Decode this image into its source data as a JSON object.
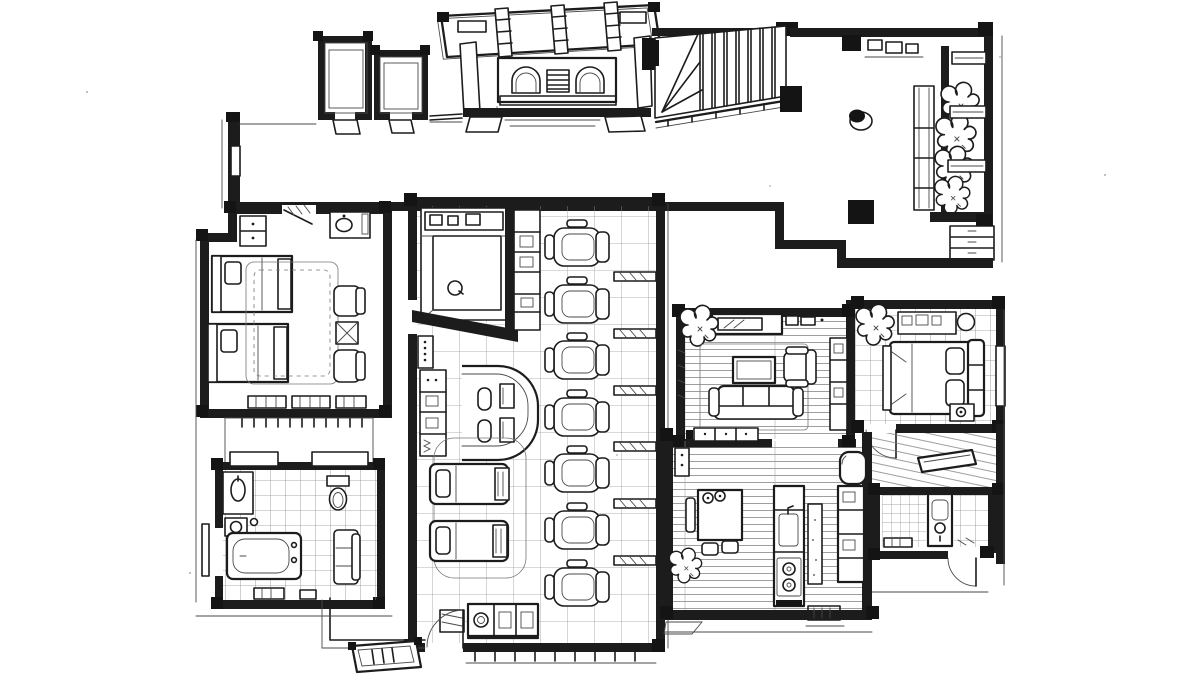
{
  "meta": {
    "title": "Hand-drawn ink floor plan",
    "medium": "black ink line drawing on white paper, axonometric apartment-salon layout",
    "palette": {
      "ink": "#1c1c1c",
      "paper": "#ffffff",
      "pencil": "#777777"
    }
  },
  "zones": {
    "upper_wing": {
      "entrance_canopy": {
        "roof_beams": 3,
        "hatched_slab": true
      },
      "tiled_closets": 2,
      "entrance_vestibule": {
        "arched_doors": 2,
        "louver_panel": 1,
        "grate_mat": 1,
        "thresholds": 2
      },
      "staircase": {
        "treads": 7,
        "winder_steps": 3,
        "railing": 1,
        "newel_posts": 2
      },
      "upper_hall": {
        "console_items": 3,
        "round_stool": 1,
        "corner_columns": 3
      },
      "gallery": {
        "planter_shrubs": 4,
        "glass_display_case": 1,
        "bridge_shelves": 3,
        "drawer_chest": 1
      },
      "corridor": {
        "shape": "L",
        "end_niche": 1
      }
    },
    "left_wing": {
      "twin_bedroom": {
        "single_beds": 2,
        "dresser": 1,
        "bedside_chest": 1,
        "washbasin_vanity": 1,
        "lounge_chairs": 2,
        "side_table": 1,
        "area_rug": 1,
        "low_benches": 3,
        "door": 1
      },
      "tiled_lobby": {
        "tiled_floor": true
      },
      "bathroom": {
        "bathtub": 1,
        "vanity_sink": 1,
        "hand_basin": 1,
        "toilet": 1,
        "bath_bench": 1,
        "bath_mats": 2,
        "door": 1
      }
    },
    "salon": {
      "styling_chairs": 7,
      "station_partitions": 6,
      "reception_desk": {
        "monitors": 2,
        "stools": 2,
        "equipment_cabinet": 1
      },
      "massage_tables": 2,
      "massage_rug": 1,
      "shower_nook": {
        "tiled_floor": true,
        "drain": 1,
        "shelf_boxes": 3
      },
      "supply_cabinet": 1,
      "switch_panel_dots": 5,
      "storage_bench": 1,
      "floor_mat": 1,
      "entry_doormat": 1,
      "doors": 2
    },
    "right_wing": {
      "living_room": {
        "sofa_cushions": 3,
        "armchair": 1,
        "coffee_table": 1,
        "tv_console": 1,
        "media_items": 2,
        "potted_plant": 1,
        "area_rug": 1,
        "sideboard": 1,
        "wall_unit": 1
      },
      "bedroom": {
        "double_bed": 1,
        "pillows": 2,
        "headboard_panels": 3,
        "nightstand_lamp": 1,
        "vanity_dresser": 1,
        "stool": 1,
        "potted_plant": 1,
        "door": 1
      },
      "kitchen_dining": {
        "dining_table": 1,
        "canisters": 2,
        "chairs": 2,
        "bench": 1,
        "island_sink": 1,
        "stove_burners": 2,
        "counter": 1,
        "tall_cabinet": 1,
        "refrigerator": 1,
        "potted_plant": 1,
        "coat_locker": 1,
        "porch_recess": 1
      },
      "inner_hallway": {
        "wall_shelf": 1
      },
      "small_bathroom": {
        "washbasin_unit": 1,
        "bath_mat": 1,
        "tiled_floors": 2,
        "door": 1
      }
    }
  }
}
